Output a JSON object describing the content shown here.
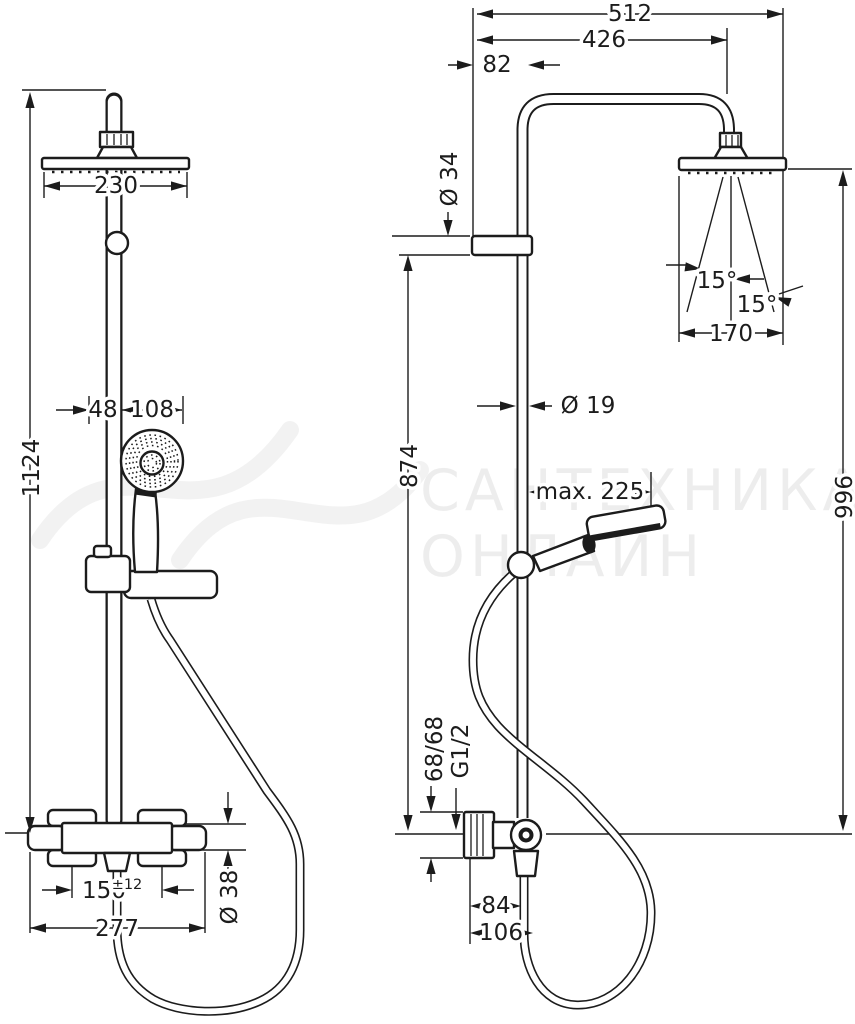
{
  "dims": {
    "d1124": "1124",
    "d230": "230",
    "d48": "48",
    "d108": "108",
    "d150": "150",
    "d150_sup": "±12",
    "d277": "277",
    "d38": "Ø 38",
    "d512": "512",
    "d426": "426",
    "d82": "82",
    "d34": "Ø 34",
    "d874": "874",
    "d996": "996",
    "d19": "Ø 19",
    "dmax225": "max. 225",
    "d15a": "15°",
    "d15b": "15°",
    "d170": "170",
    "d6868": "68/68",
    "dg12": "G1/2",
    "d84": "84",
    "d106": "106"
  },
  "watermark": {
    "line1": "САНТЕХНИКА-",
    "line2": "ОНЛАЙН"
  }
}
